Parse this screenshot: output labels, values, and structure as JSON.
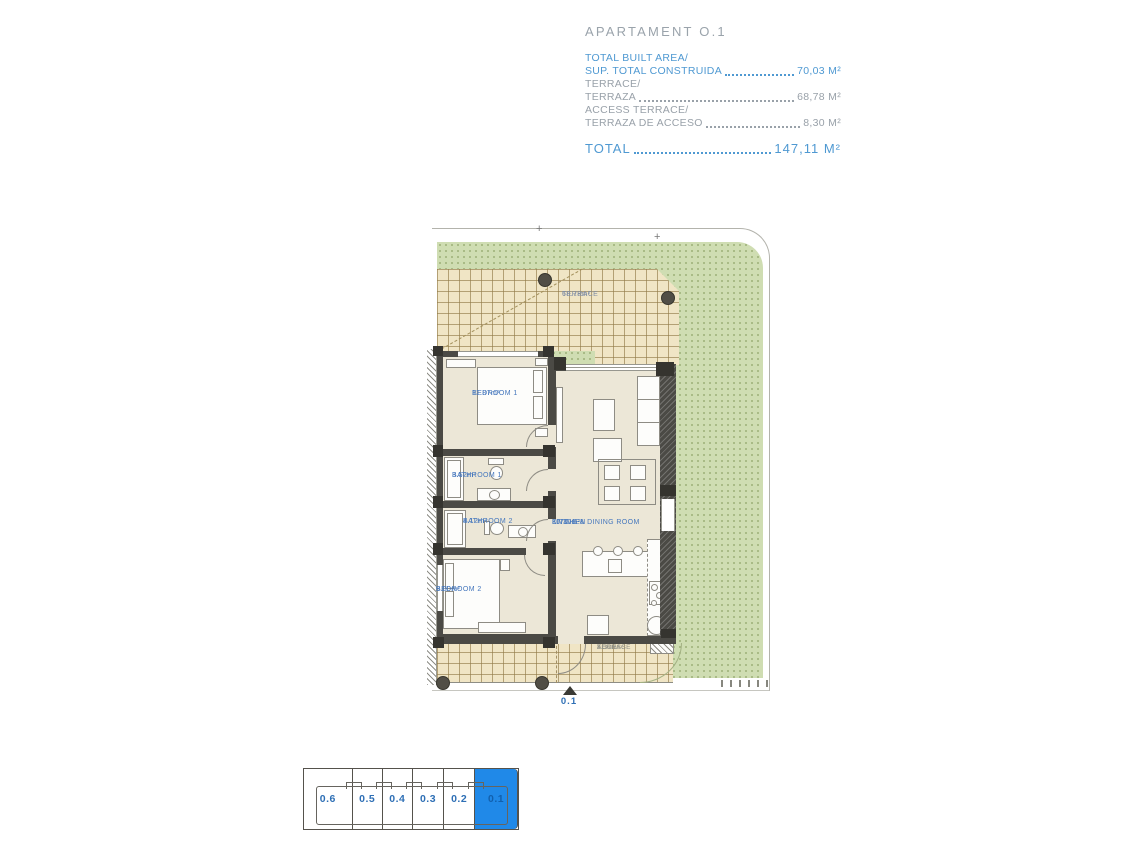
{
  "header": {
    "title": "APARTAMENT O.1",
    "areas": [
      {
        "line1": "TOTAL BUILT AREA/",
        "line2": "SUP. TOTAL CONSTRUIDA",
        "value": "70,03 M²"
      },
      {
        "line1": "TERRACE/",
        "line2": "TERRAZA",
        "value": "68,78 M²"
      },
      {
        "line1": "ACCESS TERRACE/",
        "line2": "TERRAZA DE ACCESO",
        "value": "8,30 M²"
      }
    ],
    "total_label": "TOTAL",
    "total_value": "147,11 M²"
  },
  "plan": {
    "terrace": {
      "name": "TERRACE",
      "area": "68.78m²"
    },
    "bedroom1": {
      "name": "BEDROOM 1",
      "area": "11.87m²"
    },
    "bathroom1": {
      "name": "BATHROOM 1",
      "area": "3.52m²"
    },
    "bathroom2": {
      "name": "BATHROOM 2",
      "area": "4.12m²"
    },
    "bedroom2": {
      "name": "BEDROOM 2",
      "area": "9.00m²"
    },
    "living": {
      "name_line1": "KITCHEN",
      "name_line2": "LIVING & DINING ROOM",
      "area": "30.30m²"
    },
    "access_terrace": {
      "name_line1": "ACCESS",
      "name_line2": "TERRACE",
      "area": "8.30m²"
    },
    "entrance_marker": "0.1",
    "boundary_marker": "+"
  },
  "keyplan": {
    "units": [
      {
        "label": "0.6",
        "active": false
      },
      {
        "label": "0.5",
        "active": false
      },
      {
        "label": "0.4",
        "active": false
      },
      {
        "label": "0.3",
        "active": false
      },
      {
        "label": "0.2",
        "active": false
      },
      {
        "label": "0.1",
        "active": true
      }
    ]
  },
  "colors": {
    "accent_blue": "#4f99d2",
    "text_gray": "#99a1a9",
    "room_label_blue": "#4577bd",
    "keyplan_active_blue": "#2089e8",
    "terrace_tile": "#f0e5c5",
    "garden_green": "#cfddb2",
    "wall_dark": "#4b4a45"
  }
}
